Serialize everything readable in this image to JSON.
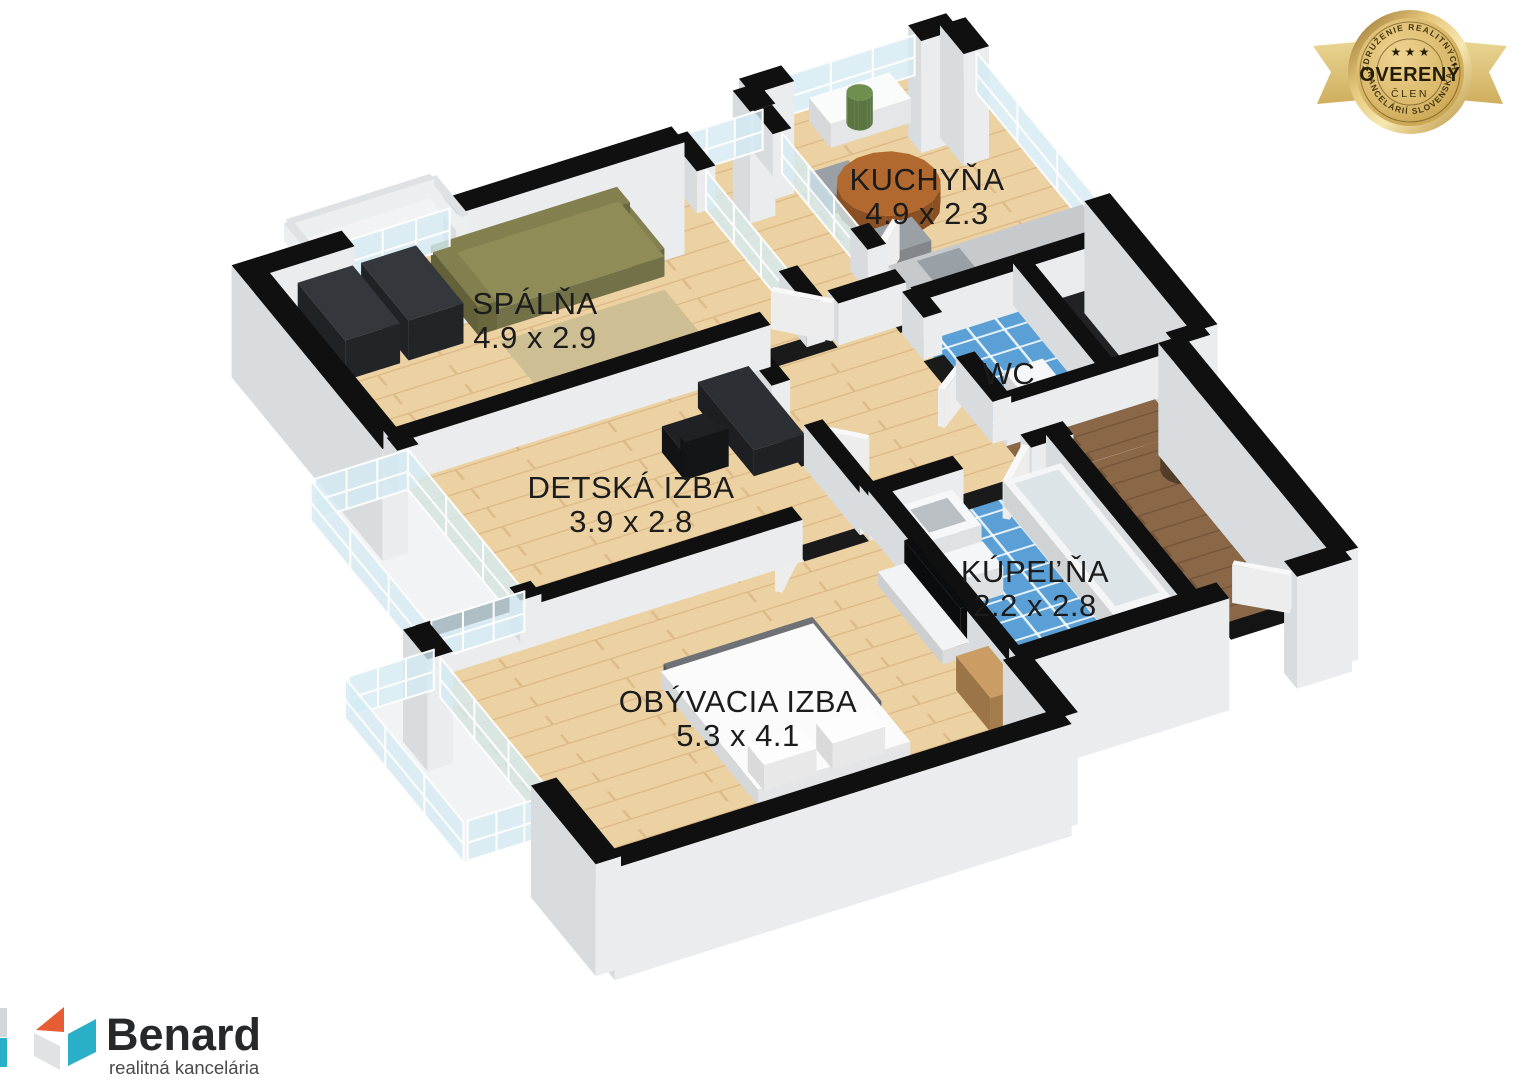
{
  "page": {
    "background": "#ffffff"
  },
  "floorplan": {
    "rooms": [
      {
        "id": "spalna",
        "name": "SPÁLŇA",
        "dims": "4.9 x 2.9"
      },
      {
        "id": "kuchyna",
        "name": "KUCHYŇA",
        "dims": "4.9 x 2.3"
      },
      {
        "id": "detska",
        "name": "DETSKÁ IZBA",
        "dims": "3.9 x 2.8"
      },
      {
        "id": "wc",
        "name": "WC",
        "dims": ""
      },
      {
        "id": "kupelna",
        "name": "KÚPEĽŇA",
        "dims": "2.2 x 2.8"
      },
      {
        "id": "obyvacia",
        "name": "OBÝVACIA IZBA",
        "dims": "5.3 x 4.1"
      }
    ],
    "colors": {
      "floor_wood": "#ecd2a2",
      "floor_wood_line": "#ddba88",
      "floor_dark_wood": "#8a6747",
      "floor_dark_wood_line": "#745539",
      "floor_tile": "#5aa0d6",
      "wall_top": "#101010",
      "label_text": "#1c1c1c"
    }
  },
  "badge": {
    "arc_top": "ZDRUŽENIE REALITNÝCH",
    "arc_bottom": "KANCELÁRIÍ SLOVENSKA",
    "stars": "★ ★ ★",
    "title": "OVERENÝ",
    "subtitle": "ČLEN",
    "colors": {
      "gold_dark": "#ad8435",
      "gold_light": "#f3e3a6",
      "text": "#42320f"
    }
  },
  "logo": {
    "name": "Benard",
    "tagline": "realitná kancelária",
    "colors": {
      "orange": "#e65c33",
      "teal": "#29b0c8",
      "gray": "#e0e2e4",
      "text": "#26282a",
      "tagline_text": "#4a4a4a"
    }
  }
}
